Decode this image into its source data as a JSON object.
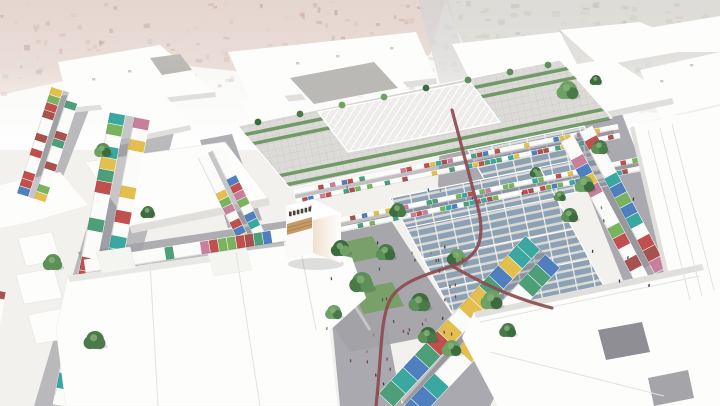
{
  "meta": {
    "title": "Aerial architectural rendering of a market district masterplan",
    "alt": "Bird's-eye 3D rendering: central market hall with white canopy roof, solar-panel market canopies, streets lined with multicolored market stalls, trees, a plaza, a maroon cycle path, surrounded by white massing buildings over a faded aerial photo"
  },
  "palette": {
    "bg": "#f2f1ee",
    "photo_left_base": "#c9a89a",
    "photo_right_base": "#b7b4aa",
    "speckle_left": [
      "#b06a55",
      "#9c5a47",
      "#c28b70",
      "#8a887d",
      "#b7b1a5",
      "#cdb9a6",
      "#a5735f"
    ],
    "speckle_right": [
      "#8f8d80",
      "#a3a093",
      "#7c7b71",
      "#aba18c",
      "#969c87",
      "#b5b2a4"
    ],
    "massing_top": "#fdfdfc",
    "massing_top2": "#f4f4f1",
    "massing_side": "#e0dfdc",
    "massing_shade": "#e9e8e5",
    "gray_roof": "#bab9b6",
    "court": "#8f8e94",
    "court2": "#a5a4a9",
    "street": "#a2a1a7",
    "street_light": "#b2b1b4",
    "road_context": "#b6b4b1",
    "pergola_bg": "#dcdbd8",
    "pergola_line": "#c8c7c4",
    "canopy_bg": "#edecea",
    "canopy_line": "#ffffff",
    "green_roof": "#5f8d55",
    "solar": "#8ca1b3",
    "solar_gap": "#dad9d6",
    "solar_frame": "#f0efec",
    "lawn": "#74a062",
    "gravel": "#cfcec9",
    "path_accent": "#8e4a50",
    "wood": "#c49a66",
    "wood_line": "#a87f4f",
    "sign_dark": "#46413a",
    "stall_colors": [
      "#c0504e",
      "#4e9e79",
      "#3aa8a0",
      "#e3bf4f",
      "#4f7fbe",
      "#a8524f",
      "#7ab35f",
      "#c77f9b"
    ],
    "stall_sat": [
      "#3aa8a0",
      "#c0504e",
      "#e3bf4f",
      "#4f7fbe",
      "#4e9e79"
    ],
    "stall_white": "#fbfbfa",
    "tree_greens": [
      "#4a7a4a",
      "#3d6b40",
      "#5d8f58",
      "#6fa065"
    ],
    "people_colors": [
      "#3a3a42",
      "#6b4a3a",
      "#85857d",
      "#47586a",
      "#8a3f3f"
    ]
  },
  "scene": {
    "context": {
      "left_pts": "0,0 445,0 430,55 300,78 150,62 0,95",
      "right_pts": "445,0 720,0 720,120 560,102 470,62",
      "speckle_count_left": 180,
      "speckle_count_right": 160
    },
    "roads": [
      {
        "n": "context-road-north",
        "pts": "418,0 448,0 476,92 444,100",
        "fill": "road_context",
        "op": 0.8
      },
      {
        "n": "street-main-ns",
        "pts": "442,94 472,88 494,214 468,248 438,186",
        "fill": "street",
        "op": 0.9
      },
      {
        "n": "street-a2",
        "pts": "58,96 96,92 48,215 10,220",
        "fill": "street_light",
        "op": 0.9
      },
      {
        "n": "street-a",
        "pts": "118,122 178,118 100,406 34,406",
        "fill": "street_light",
        "op": 0.9
      },
      {
        "n": "street-hall-west",
        "pts": "200,140 232,134 262,220 228,228",
        "fill": "street",
        "op": 0.85
      },
      {
        "n": "street-bl",
        "pts": "78,252 306,218 312,238 84,272",
        "fill": "street",
        "op": 0.85
      },
      {
        "n": "street-b",
        "pts": "560,122 622,114 690,292 634,308",
        "fill": "street",
        "op": 0.9
      },
      {
        "n": "street-c",
        "pts": "648,288 720,272 720,330 664,322",
        "fill": "street",
        "op": 0.9
      },
      {
        "n": "street-s67",
        "pts": "536,250 570,246 490,406 400,406",
        "fill": "street",
        "op": 0.9
      },
      {
        "n": "street-plaza-south",
        "pts": "330,300 380,290 402,406 340,406",
        "fill": "street",
        "op": 0.9
      }
    ],
    "massing": [
      {
        "n": "block-north-1",
        "pts": "228,52 416,32 436,78 250,100",
        "f": "t"
      },
      {
        "n": "block-north-1-side",
        "pts": "250,100 436,78 437,84 251,106",
        "f": "s"
      },
      {
        "n": "block-north-2",
        "pts": "452,44 560,32 580,70 472,84",
        "f": "t"
      },
      {
        "n": "block-north-3",
        "pts": "560,30 640,22 700,48 600,66",
        "f": "t"
      },
      {
        "n": "block-north-3-side",
        "pts": "600,66 700,48 701,53 601,71",
        "f": "s"
      },
      {
        "n": "block-north-4",
        "pts": "648,28 720,16 720,52 668,52",
        "f": "t"
      },
      {
        "n": "block-ne-1",
        "pts": "640,70 720,52 720,104 660,118",
        "f": "t"
      },
      {
        "n": "block-ne-2",
        "pts": "470,85 560,70 600,95 510,112",
        "f": "t"
      },
      {
        "n": "block-courtyard",
        "pts": "495,80 610,58 672,98 557,122",
        "f": "t"
      },
      {
        "n": "block-courtyard-side",
        "pts": "557,122 672,98 674,104 559,128",
        "f": "s"
      },
      {
        "n": "block-tl-1",
        "pts": "58,62 160,45 215,92 70,108",
        "f": "t"
      },
      {
        "n": "block-tl-1-side",
        "pts": "70,108 215,92 216,97 71,113",
        "f": "s"
      },
      {
        "n": "block-tl-gray",
        "pts": "150,58 180,54 192,70 162,75",
        "f": "g"
      },
      {
        "n": "block-tl-2",
        "pts": "100,105 165,95 190,125 120,140",
        "f": "t"
      },
      {
        "n": "block-tl-2-side",
        "pts": "120,140 190,125 191,130 121,145",
        "f": "s"
      },
      {
        "n": "block-tl-3",
        "pts": "0,185 60,172 88,205 30,222 0,228",
        "f": "t"
      },
      {
        "n": "block-annex-rim",
        "pts": "282,72 380,56 408,88 310,104",
        "f": "t"
      },
      {
        "n": "roof-annex-gray",
        "pts": "290,78 374,62 398,88 314,104",
        "f": "g"
      },
      {
        "n": "block-hall-nw",
        "pts": "238,100 282,92 296,112 252,120",
        "f": "t"
      }
    ],
    "mid_massing": [
      {
        "n": "block-bl-1",
        "pts": "85,162 225,142 268,198 130,226",
        "f": "t"
      },
      {
        "n": "block-bl-1-side",
        "pts": "130,226 268,198 270,205 132,233",
        "f": "s"
      },
      {
        "n": "box-left-1",
        "pts": "18,238 52,232 60,260 26,266",
        "f": "t"
      },
      {
        "n": "box-left-2",
        "pts": "16,275 54,268 62,298 24,304",
        "f": "t"
      },
      {
        "n": "box-left-3",
        "pts": "28,315 64,308 70,338 36,344",
        "f": "t"
      }
    ],
    "fore_massing": [
      {
        "n": "slab-right-mid",
        "pts": "634,126 720,106 720,290 676,306",
        "f": "t"
      },
      {
        "n": "slab-right-mid-side",
        "pts": "630,128 634,126 676,306 672,308",
        "f": "s"
      }
    ],
    "fore_massing2": [
      {
        "n": "mass-bottom-left",
        "pts": "68,276 236,252 300,244 352,258 366,298 330,330 338,406 66,406 56,330",
        "f": "t"
      },
      {
        "n": "mass-bottom-left-shade",
        "pts": "68,276 236,252 238,258 70,282",
        "f": "sh"
      },
      {
        "n": "box-on-mass-1",
        "pts": "96,252 130,247 136,268 102,273",
        "f": "t2"
      },
      {
        "n": "box-on-mass-2",
        "pts": "208,254 246,248 252,270 214,276",
        "f": "t2"
      }
    ],
    "fore_massing3": [
      {
        "n": "slab-bottom-right",
        "pts": "474,312 702,264 720,268 720,406 498,406 462,338",
        "f": "t"
      },
      {
        "n": "slab-bottom-right-side",
        "pts": "474,312 702,264 704,270 476,318",
        "f": "s"
      },
      {
        "n": "courtyard-1",
        "pts": "598,330 642,322 650,352 606,360",
        "f": "c"
      },
      {
        "n": "courtyard-2",
        "pts": "648,378 688,370 694,398 654,406",
        "f": "c2"
      }
    ],
    "facet_lines": [
      "648,130 690,300",
      "660,128 702,296",
      "672,124 714,290",
      "150,262 158,406",
      "236,252 260,406",
      "300,246 316,330",
      "480,322 700,276",
      "490,352 664,396"
    ],
    "hall": {
      "top_pts": "238,126 560,60 612,118 290,188",
      "canopy_pts": "318,112 470,82 500,122 348,152",
      "green_rows": [
        "244,133 566,67 569,70 247,136",
        "252,142 574,76 577,79 255,145",
        "279,174 601,108 604,111 282,177",
        "286,183 608,117 611,120 289,186"
      ]
    },
    "solar_fields": [
      {
        "n": "solar-canopy-east",
        "pts": "468,150 584,126 616,184 500,208",
        "beams": [
          "476,164 592,140",
          "484,179 600,155",
          "492,193 608,169"
        ]
      },
      {
        "n": "solar-canopy-south",
        "pts": "390,198 540,168 606,290 456,320",
        "beams": [
          "406,228 556,198",
          "423,259 573,229",
          "439,289 589,259"
        ]
      }
    ],
    "plaza": {
      "pts": "296,236 388,216 462,330 350,352 316,300",
      "lawns": [
        "334,244 372,236 384,256 346,264",
        "352,290 392,282 404,306 364,314",
        "310,262 334,257 342,276 318,281"
      ],
      "gravel": [
        "320,250 370,330",
        "304,252 360,302"
      ]
    },
    "stall_strips": [
      {
        "n": "stalls-left-edge",
        "x": 6,
        "y": 292,
        "a": 101,
        "len": 110,
        "w": 8,
        "h": 10,
        "rows": 1,
        "aisle": 0,
        "wp": 0.4,
        "pal": "std",
        "grow": 0.8
      },
      {
        "n": "stalls-street-a2",
        "x": 80,
        "y": 96,
        "a": 108,
        "len": 112,
        "w": 8,
        "h": 12,
        "rows": 2,
        "aisle": 6,
        "wp": 0.45,
        "pal": "std",
        "grow": 0
      },
      {
        "n": "stalls-street-a",
        "x": 150,
        "y": 120,
        "a": 101,
        "len": 288,
        "w": 11,
        "h": 16,
        "rows": 2,
        "aisle": 9,
        "wp": 0.45,
        "pal": "std",
        "grow": 0.5
      },
      {
        "n": "stalls-hall-west",
        "x": 222,
        "y": 146,
        "a": 64,
        "len": 92,
        "w": 8,
        "h": 11,
        "rows": 2,
        "aisle": 5,
        "wp": 0.5,
        "pal": "std",
        "grow": 0
      },
      {
        "n": "stalls-bl-south",
        "x": 84,
        "y": 260,
        "a": -9,
        "len": 200,
        "w": 9,
        "h": 13,
        "rows": 2,
        "aisle": 6,
        "wp": 0.4,
        "pal": "std",
        "grow": 0
      },
      {
        "n": "hall-terrace-1",
        "x": 294,
        "y": 190,
        "a": -11.5,
        "len": 325,
        "w": 6,
        "h": 5,
        "rows": 2,
        "aisle": 4,
        "wp": 0.62,
        "pal": "std",
        "grow": 0
      },
      {
        "n": "hall-terrace-2",
        "x": 320,
        "y": 222,
        "a": -11.5,
        "len": 325,
        "w": 6,
        "h": 5,
        "rows": 2,
        "aisle": 4,
        "wp": 0.62,
        "pal": "std",
        "grow": 0
      },
      {
        "n": "stalls-street-b",
        "x": 592,
        "y": 126,
        "a": 62,
        "len": 150,
        "w": 10,
        "h": 14,
        "rows": 2,
        "aisle": 7,
        "wp": 0.45,
        "pal": "std",
        "grow": 0.3
      },
      {
        "n": "stalls-solar-edge",
        "x": 452,
        "y": 332,
        "a": -13,
        "len": 160,
        "w": 8,
        "h": 6,
        "rows": 1,
        "aisle": 0,
        "wp": 0.35,
        "pal": "sat",
        "grow": 0
      }
    ],
    "stall_strips_c": [
      {
        "n": "stalls-street-c",
        "x": 654,
        "y": 296,
        "a": -12,
        "len": 70,
        "w": 9,
        "h": 13,
        "rows": 2,
        "aisle": 5,
        "wp": 0.35,
        "pal": "sat",
        "grow": 0
      }
    ],
    "stall_strips_s67": [
      {
        "n": "stalls-street-s67",
        "x": 560,
        "y": 268,
        "a": 133,
        "len": 205,
        "w": 13,
        "h": 20,
        "rows": 2,
        "aisle": 7,
        "wp": 0.3,
        "pal": "sat",
        "grow": 0.4
      }
    ],
    "cube": {
      "left_pts": "286,206 313,199 313,253 286,259",
      "right_pts": "313,199 341,213 341,263 313,253",
      "top_pts": "286,206 313,199 341,213 314,220",
      "wood_pts": "287,224 312,217 312,228 287,235",
      "signage_marks": 6
    },
    "trees": [
      [
        103,
        150,
        7
      ],
      [
        53,
        262,
        8
      ],
      [
        95,
        340,
        9
      ],
      [
        148,
        212,
        6
      ],
      [
        568,
        90,
        9
      ],
      [
        596,
        80,
        5
      ],
      [
        600,
        147,
        7
      ],
      [
        585,
        184,
        8
      ],
      [
        570,
        215,
        7
      ],
      [
        341,
        248,
        8
      ],
      [
        362,
        282,
        10
      ],
      [
        420,
        302,
        9
      ],
      [
        457,
        257,
        8
      ],
      [
        492,
        300,
        9
      ],
      [
        398,
        210,
        7
      ],
      [
        386,
        252,
        8
      ],
      [
        428,
        335,
        8
      ],
      [
        452,
        348,
        8
      ],
      [
        508,
        330,
        7
      ],
      [
        334,
        312,
        7
      ],
      [
        536,
        172,
        5
      ],
      [
        560,
        196,
        5
      ]
    ],
    "trees_small": [
      [
        258,
        122
      ],
      [
        300,
        114
      ],
      [
        342,
        105
      ],
      [
        384,
        97
      ],
      [
        426,
        88
      ],
      [
        468,
        80
      ],
      [
        510,
        72
      ],
      [
        548,
        65
      ]
    ],
    "roof_marks": [
      [
        296,
        62
      ],
      [
        336,
        55
      ],
      [
        390,
        47
      ],
      [
        508,
        96
      ],
      [
        92,
        78
      ],
      [
        128,
        70
      ],
      [
        660,
        80
      ],
      [
        690,
        64
      ]
    ],
    "red_path": [
      "M452,110 L478,208 C486,240 478,258 452,266 C420,276 398,284 390,300 C380,320 382,352 376,406",
      "M452,266 C490,288 520,300 552,308"
    ],
    "people_zones": [
      {
        "x": 320,
        "y": 240,
        "w": 150,
        "h": 105,
        "count": 22
      },
      {
        "x": 348,
        "y": 350,
        "w": 44,
        "h": 54,
        "count": 8
      },
      {
        "x": 575,
        "y": 180,
        "w": 80,
        "h": 110,
        "count": 8
      },
      {
        "x": 430,
        "y": 250,
        "w": 50,
        "h": 50,
        "count": 8
      },
      {
        "x": 300,
        "y": 170,
        "w": 300,
        "h": 40,
        "count": 6
      }
    ]
  }
}
